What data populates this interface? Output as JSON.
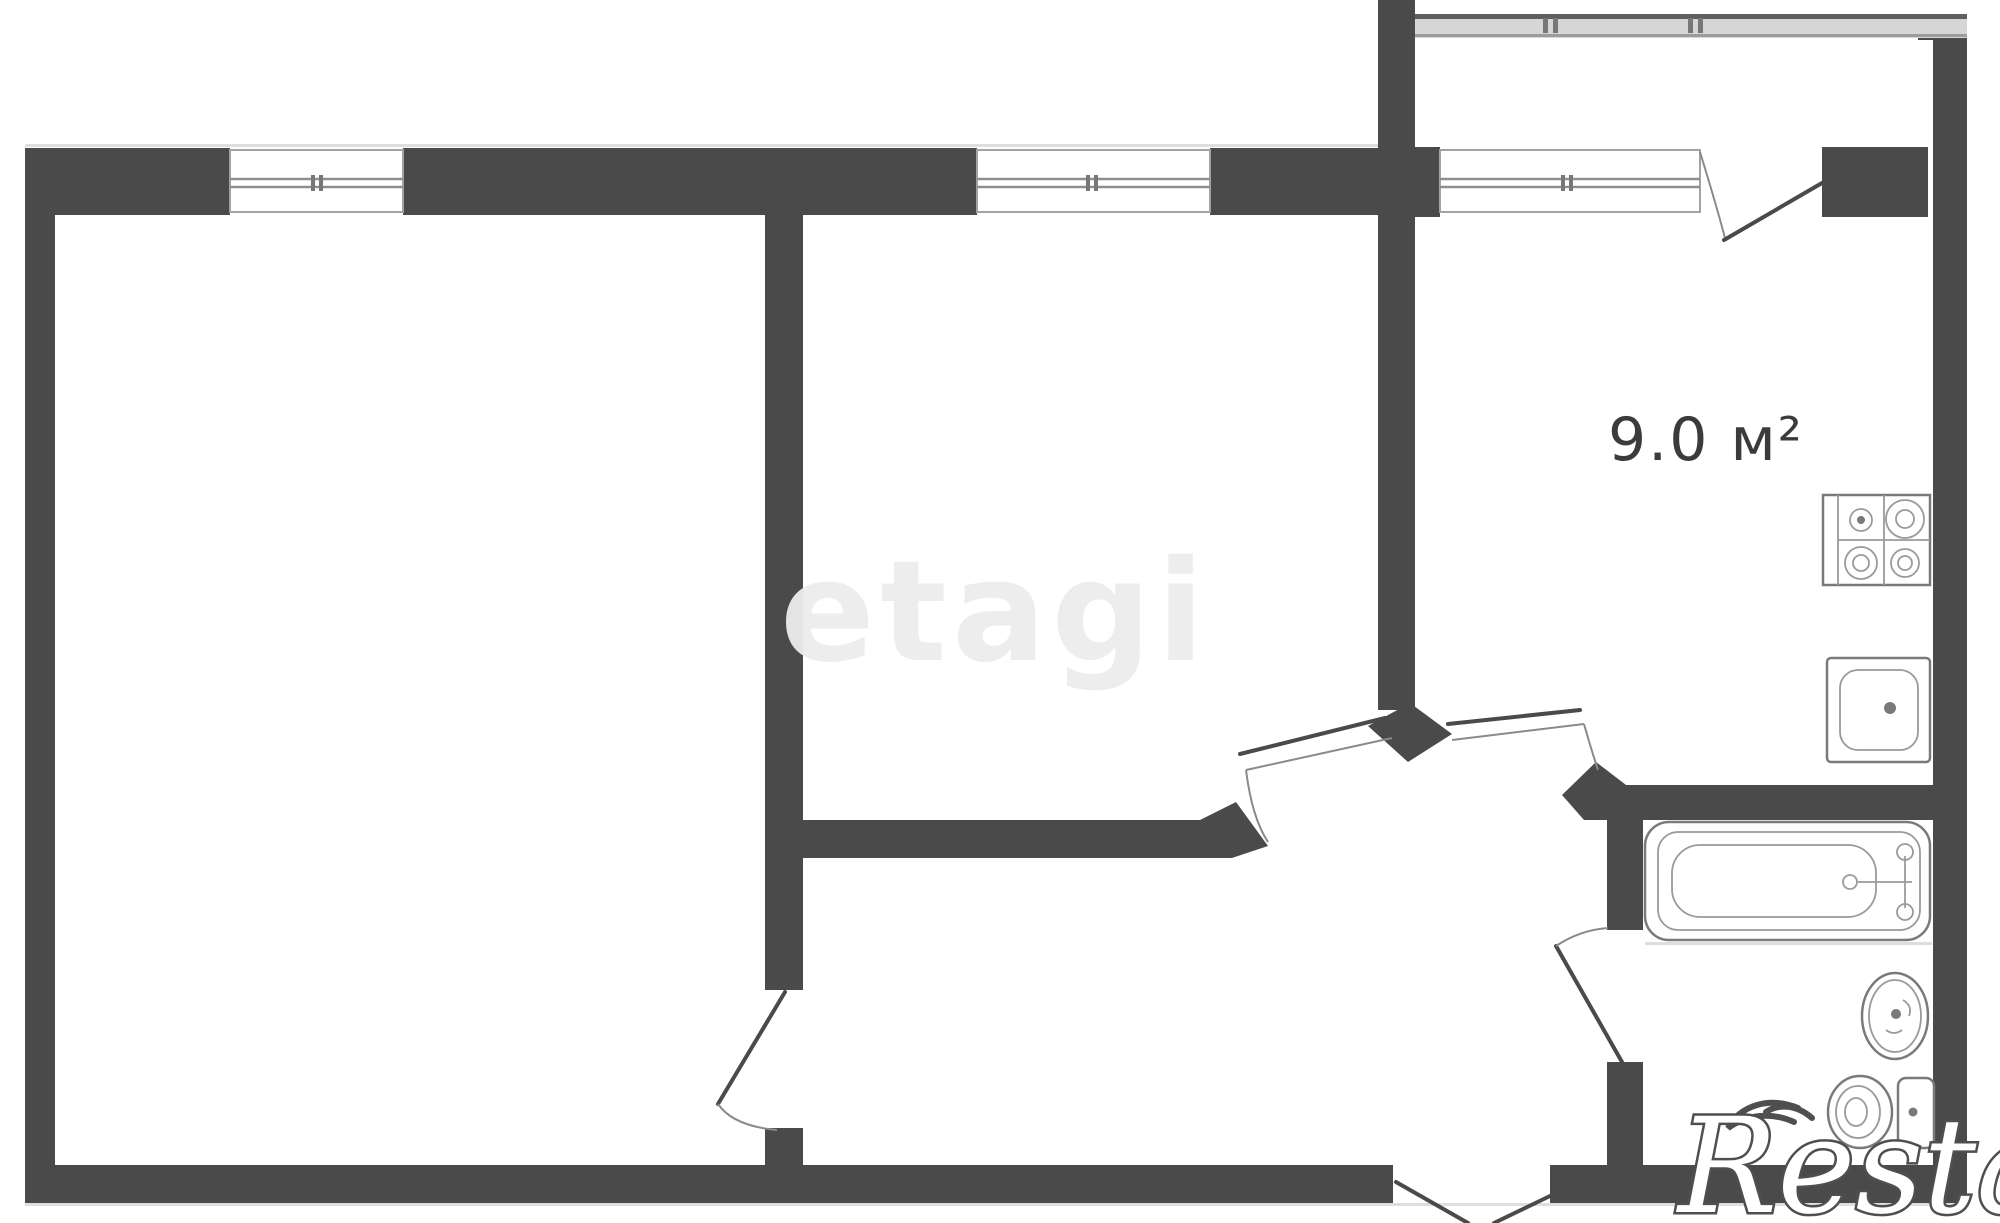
{
  "page": {
    "width": 2000,
    "height": 1223,
    "background": "#ffffff",
    "type": "apartment-floor-plan"
  },
  "colors": {
    "wall": "#4a4a4a",
    "window_frame": "#a3a3a3",
    "window_line": "#8f8f8f",
    "fixture_outline": "#7a7a7a",
    "door_line": "#4a4a4a",
    "balcony_fill": "#d6d6d6",
    "label_text": "#3b3b3b",
    "watermark_etagi": "#ededed",
    "restate_fill": "#ffffff",
    "restate_outline": "#4f4f4f"
  },
  "floorplan": {
    "kitchen": {
      "area_label": "9.0 м²"
    },
    "rooms": [
      "room-1",
      "room-2",
      "kitchen",
      "hallway",
      "bathroom",
      "balcony"
    ],
    "icons": [
      "stove-icon",
      "kitchen-sink-icon",
      "bathtub-icon",
      "washbasin-icon",
      "toilet-icon",
      "window-icon",
      "door-swing-icon",
      "balcony-rail-icon"
    ]
  },
  "watermarks": {
    "center": "etagi",
    "bottom_right": "Restate"
  }
}
